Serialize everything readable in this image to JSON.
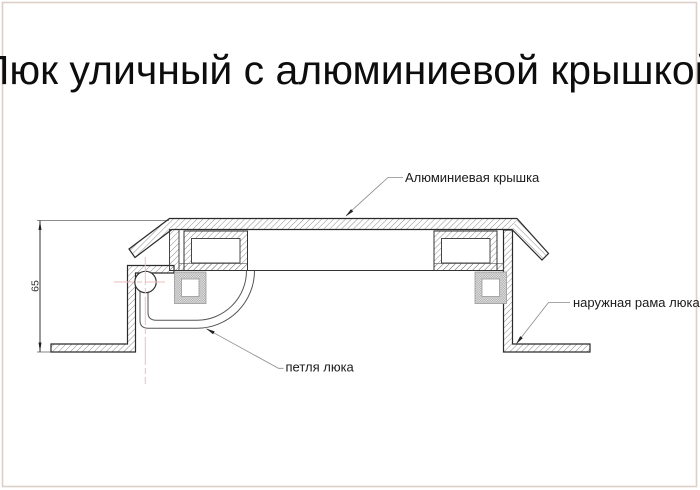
{
  "page": {
    "title": "Люк уличный с алюминиевой крышкой",
    "border_color": "#ddcfc9",
    "background": "#ffffff"
  },
  "drawing": {
    "type": "technical-cross-section",
    "subject": "street hatch with aluminum cover, side section view",
    "annotations": {
      "cover_label": "Алюминиевая крышка",
      "frame_label": "наружная рама люка",
      "hinge_label": "петля люка"
    },
    "dimension": {
      "value": "65",
      "measures": "height from cover top to frame bottom flange"
    },
    "colors": {
      "outline": "#2a2a2a",
      "thin_line": "#555555",
      "hatch": "#686868",
      "centerline_pink": "#eebcbc",
      "leader": "#8a8a8a",
      "tube_fill": "#aaaaaa"
    }
  }
}
